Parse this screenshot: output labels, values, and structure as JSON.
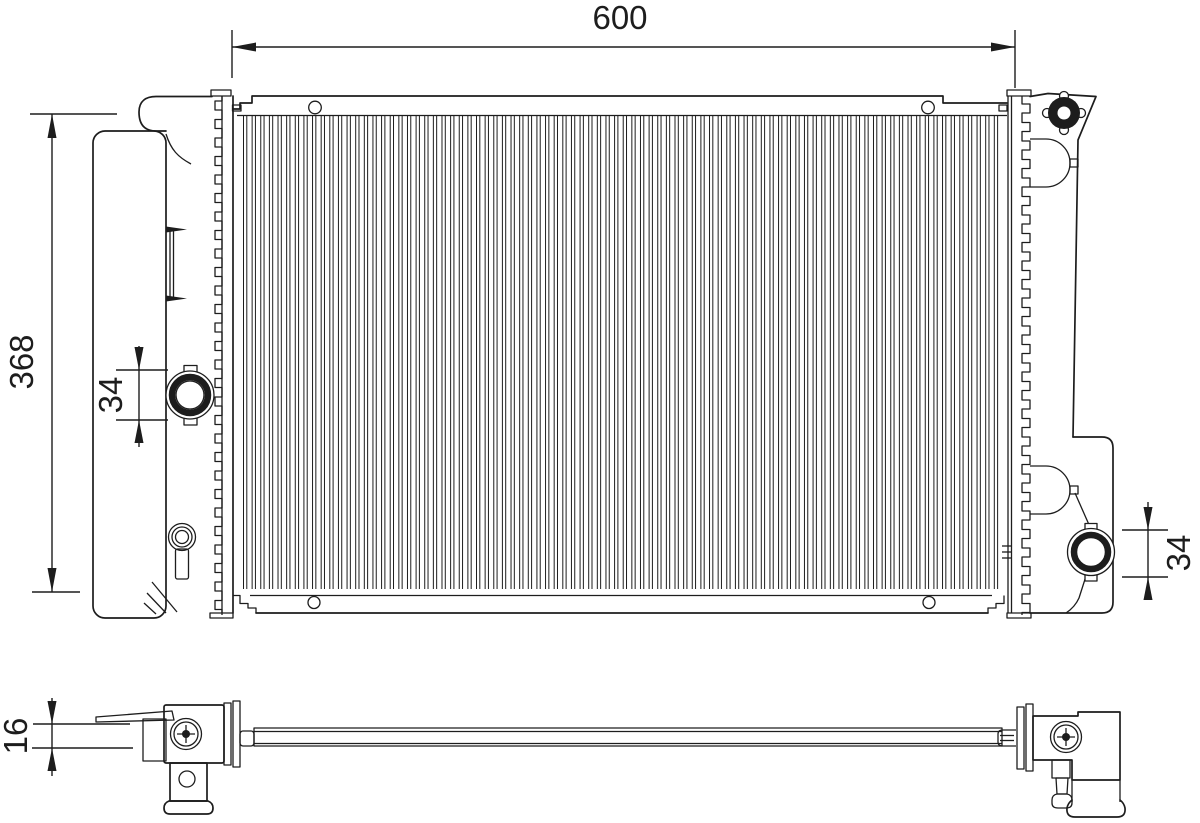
{
  "drawing": {
    "subject": "radiator-technical-drawing",
    "style": "line-art",
    "background": "#ffffff",
    "line_color": "#1d1d1d",
    "views": {
      "front": {
        "name": "front-view",
        "dimensions": {
          "width": {
            "value": "600"
          },
          "height": {
            "value": "368"
          },
          "inlet_port_diameter": {
            "value": "34"
          },
          "outlet_port_diameter": {
            "value": "34"
          }
        }
      },
      "profile": {
        "name": "bottom-profile-view",
        "dimensions": {
          "thickness": {
            "value": "16"
          }
        }
      }
    }
  }
}
